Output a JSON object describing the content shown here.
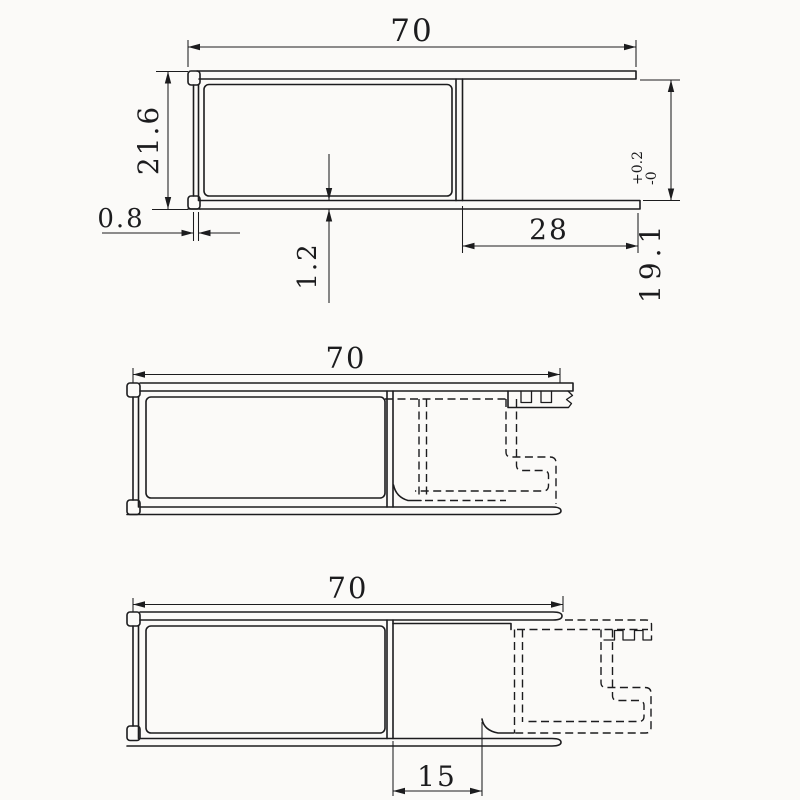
{
  "page": {
    "background": "#fbfaf8",
    "line_color": "#1c1c1e",
    "description_visible_text_only": true
  },
  "drawings": {
    "top_section": {
      "dims": {
        "overall_width": "70",
        "overall_height": "21.6",
        "wall_thickness": "0.8",
        "web_thickness": "1.2",
        "channel_width": "28",
        "inner_height": "19.1",
        "tolerance_upper": "+0.2",
        "tolerance_lower": "-0"
      }
    },
    "middle_assembly": {
      "dims": {
        "overall_width": "70"
      }
    },
    "bottom_assembly": {
      "dims": {
        "overall_width": "70",
        "sash_offset": "15"
      }
    }
  }
}
